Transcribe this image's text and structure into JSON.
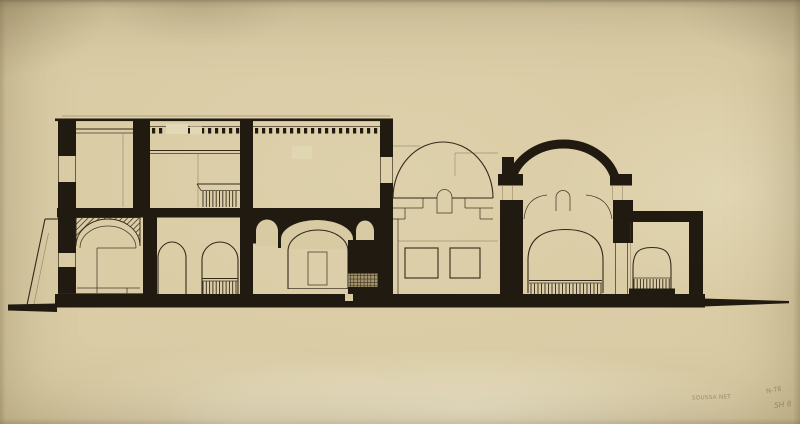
{
  "document": {
    "subject": "Sectional elevation drawing of a domed building, black ink on toned paper"
  },
  "annotations": {
    "site_note": "SOUSSA NET",
    "reference_top": "N-78",
    "sheet_number": "SH 8"
  },
  "colors": {
    "paper": "#d7c9a1",
    "paper_light": "#e2d8b5",
    "ink": "#211a10",
    "line": "#342a1a",
    "pencil": "#8d8160"
  }
}
